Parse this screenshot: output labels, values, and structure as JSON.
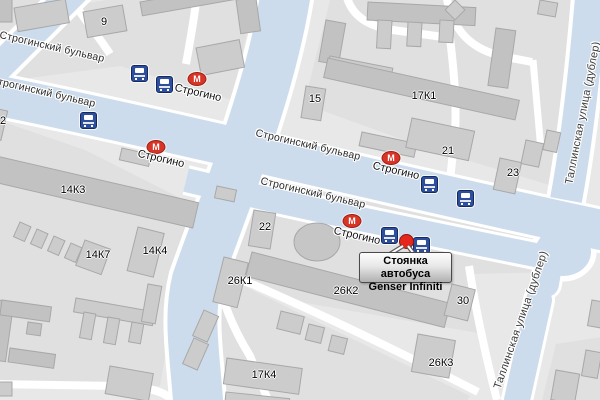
{
  "map_title": "Карта района Строгино",
  "colors": {
    "land": "#e8e8e8",
    "block": "#e0e0e0",
    "road_white": "#ffffff",
    "road_blue": "#cddcec",
    "building": "#cccccc",
    "building_dark": "#c2c2c2",
    "metro_red": "#d93526",
    "bus_blue": "#2d4f9e",
    "marker_red": "#e5261c"
  },
  "road_labels": [
    {
      "text": "Строгинский бульвар",
      "x": 52,
      "y": 47,
      "rot": 13,
      "vert": false
    },
    {
      "text": "Строгинский бульвар",
      "x": 43,
      "y": 92,
      "rot": 13,
      "vert": false
    },
    {
      "text": "Строгинский бульвар",
      "x": 308,
      "y": 145,
      "rot": 13,
      "vert": false
    },
    {
      "text": "Строгинский бульвар",
      "x": 313,
      "y": 193,
      "rot": 13,
      "vert": false
    },
    {
      "text": "Таллинская улица (дублер)",
      "x": 583,
      "y": 113,
      "rot": -79,
      "vert": true
    },
    {
      "text": "Таллинская улица (дублер)",
      "x": 521,
      "y": 320,
      "rot": -71,
      "vert": true
    }
  ],
  "building_labels": [
    {
      "text": "9",
      "x": 104,
      "y": 22
    },
    {
      "text": "2",
      "x": 3,
      "y": 121
    },
    {
      "text": "15",
      "x": 315,
      "y": 99
    },
    {
      "text": "17К1",
      "x": 424,
      "y": 96
    },
    {
      "text": "21",
      "x": 448,
      "y": 151
    },
    {
      "text": "23",
      "x": 513,
      "y": 173
    },
    {
      "text": "14К3",
      "x": 73,
      "y": 190
    },
    {
      "text": "14К7",
      "x": 98,
      "y": 255
    },
    {
      "text": "14К4",
      "x": 155,
      "y": 251
    },
    {
      "text": "22",
      "x": 265,
      "y": 227
    },
    {
      "text": "26К1",
      "x": 240,
      "y": 281
    },
    {
      "text": "26К2",
      "x": 346,
      "y": 291
    },
    {
      "text": "30",
      "x": 463,
      "y": 301
    },
    {
      "text": "26К3",
      "x": 441,
      "y": 363
    },
    {
      "text": "17К4",
      "x": 264,
      "y": 375
    }
  ],
  "metro": {
    "name": "Строгино",
    "letter": "М",
    "entrances": [
      {
        "x": 197,
        "y": 79,
        "label_x": 198,
        "label_y": 93,
        "label_rot": 13
      },
      {
        "x": 156,
        "y": 147,
        "label_x": 161,
        "label_y": 159,
        "label_rot": 13
      },
      {
        "x": 391,
        "y": 158,
        "label_x": 396,
        "label_y": 171,
        "label_rot": 13
      },
      {
        "x": 352,
        "y": 221,
        "label_x": 357,
        "label_y": 236,
        "label_rot": 13
      }
    ]
  },
  "bus_stops": [
    {
      "x": 139,
      "y": 73
    },
    {
      "x": 164,
      "y": 84
    },
    {
      "x": 88,
      "y": 120
    },
    {
      "x": 429,
      "y": 184
    },
    {
      "x": 465,
      "y": 198
    },
    {
      "x": 389,
      "y": 235
    },
    {
      "x": 421,
      "y": 245
    }
  ],
  "poi_marker": {
    "x": 406,
    "y": 241
  },
  "callout": {
    "line1": "Стоянка автобуса",
    "line2": "Genser Infiniti"
  }
}
